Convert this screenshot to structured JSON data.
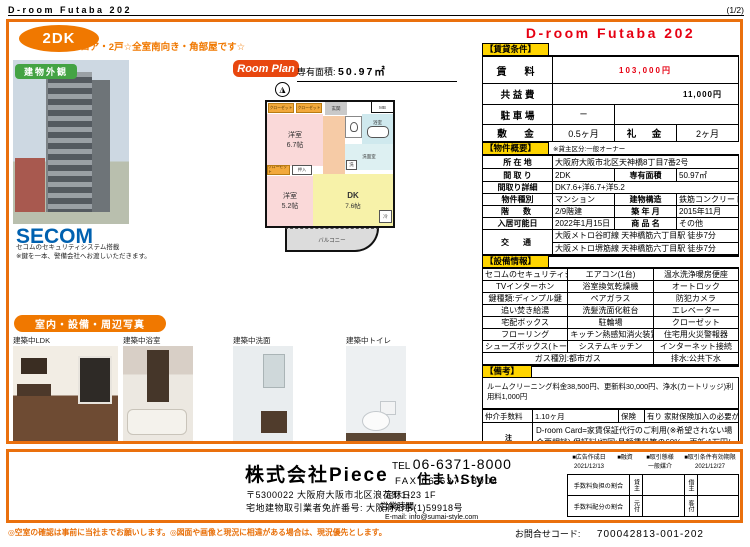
{
  "page": {
    "doc_title": "D-room Futaba 202",
    "page_indicator": "(1/2)"
  },
  "header": {
    "type_badge": "2DK",
    "catchphrase": "☆1フロア・2戸☆全室南向き・角部屋です☆",
    "title": "D-room Futaba 202"
  },
  "left": {
    "exterior_label": "建物外観",
    "secom_logo": "SECOM",
    "secom_note1": "セコムのセキュリティシステム搭載",
    "secom_note2": "※鍵を一本、警備会社へお渡しいただきます。",
    "photos_label": "室内・設備・周辺写真",
    "photo_captions": [
      "建築中LDK",
      "建築中浴室",
      "建築中洗面",
      "建築中トイレ"
    ]
  },
  "floorplan": {
    "label": "Room Plan",
    "area_label": "専有面積:",
    "area_value": "50.97㎡",
    "compass": "N",
    "rooms": {
      "west1": "洋室",
      "west1_size": "6.7帖",
      "west2": "洋室",
      "west2_size": "5.2帖",
      "dk": "DK",
      "dk_size": "7.6帖",
      "entrance": "玄関",
      "mb": "MB",
      "bath": "浴室",
      "wash": "洗面室",
      "washer": "洗",
      "fridge": "冷",
      "closet1": "クローゼット",
      "closet2": "クローゼット",
      "closet3": "クローゼット",
      "oshiire": "押入",
      "balcony": "バルコニー"
    }
  },
  "rental": {
    "section_label": "【賃貸条件】",
    "rent_label": "賃　料",
    "rent_value": "103,000円",
    "fee_label": "共 益 費",
    "fee_value": "11,000円",
    "parking_label": "駐 車 場",
    "parking_value": "ー",
    "deposit_label": "敷　金",
    "deposit_value": "0.5ヶ月",
    "key_label": "礼　金",
    "key_value": "2ヶ月"
  },
  "overview": {
    "section_label": "【物件概要】",
    "owner_note": "※貸主区分:一般オーナー",
    "location_label": "所 在 地",
    "location": "大阪府大阪市北区天神橋8丁目7番2号",
    "layout_label": "間 取 り",
    "layout": "2DK",
    "area_label": "専有面積",
    "area": "50.97㎡",
    "layout_detail_label": "間取り詳細",
    "layout_detail": "DK7.6+洋6.7+洋5.2",
    "type_label": "物件種別",
    "type": "マンション",
    "structure_label": "建物構造",
    "structure": "鉄筋コンクリート造",
    "floor_label": "階　数",
    "floor": "2/9階建",
    "built_label": "築 年 月",
    "built": "2015年11月",
    "movein_label": "入居可能日",
    "movein": "2022年1月15日",
    "product_label": "商 品 名",
    "product": "その他",
    "access_label": "交　通",
    "access1": "大阪メトロ谷町線 天神橋筋六丁目駅 徒歩7分",
    "access2": "大阪メトロ堺筋線 天神橋筋六丁目駅 徒歩7分"
  },
  "equipment": {
    "section_label": "【設備情報】",
    "rows": [
      [
        "セコムのセキュリティシステム",
        "エアコン(1台)",
        "温水洗浄暖房便座"
      ],
      [
        "TVインターホン",
        "浴室換気乾燥機",
        "オートロック"
      ],
      [
        "鍵種類:ディンプル鍵",
        "ペアガラス",
        "防犯カメラ"
      ],
      [
        "追い焚き給湯",
        "洗髪洗面化粧台",
        "エレベーター"
      ],
      [
        "宅配ボックス",
        "駐輪場",
        "クローゼット"
      ],
      [
        "フローリング",
        "キッチン熱感知消火装置",
        "住宅用火災警報器"
      ],
      [
        "シューズボックス(トールタイプ)",
        "システムキッチン",
        "インターネット接続"
      ]
    ],
    "gas": "ガス種別:都市ガス",
    "drain": "排水:公共下水"
  },
  "remarks": {
    "section_label": "【備考】",
    "fees_line": "ルームクリーニング料金38,500円、更新料30,000円、浄水(カートリッジ)利用料1,000円",
    "agency_fee_label": "仲介手数料",
    "agency_fee": "1.10ヶ月",
    "insurance_label": "保険",
    "insurance": "有り 家財保険加入の必要があります。",
    "notes_label": "注意事項",
    "notes_text": "D-room Card=家賃保証代行のご利用(※希望されない場合要相談) 保証料/初回:月額賃料等の60%、更新:1万円/年間"
  },
  "company": {
    "name": "株式会社Piece",
    "brand": "住まいStyle",
    "address": "〒5300022 大阪府大阪市北区浪花町1-23 1F",
    "license": "宅地建物取引業者免許番号: 大阪府知事(1)59918号",
    "tel_label": "TEL",
    "tel": "06-6371-8000",
    "fax_label": "FAX",
    "fax": "06-6371-8004",
    "closed_label": "定休日:",
    "hours_label": "営業時間:",
    "email_label": "E-mail:",
    "email": "info@sumai-style.com",
    "ad_date_label": "■広告作成日",
    "ad_date": "2021/12/13",
    "loan_label": "■融資",
    "transaction_label": "■取引態様",
    "transaction": "一般媒介",
    "validity_label": "■取引条件有効期限",
    "validity": "2021/12/27",
    "fee_share_label": "手数料負担の割合",
    "fee_share_left": "貸主",
    "fee_share_right": "借主",
    "fee_split_label": "手数料配分の割合",
    "fee_split_left": "元付",
    "fee_split_right": "客付"
  },
  "footer": {
    "note": "◎空室の確認は事前に当社までお願いします。◎図面や画像と現況に相違がある場合は、現況優先とします。",
    "inquiry_label": "お問合せコード:",
    "inquiry_code": "700042813-001-202"
  }
}
